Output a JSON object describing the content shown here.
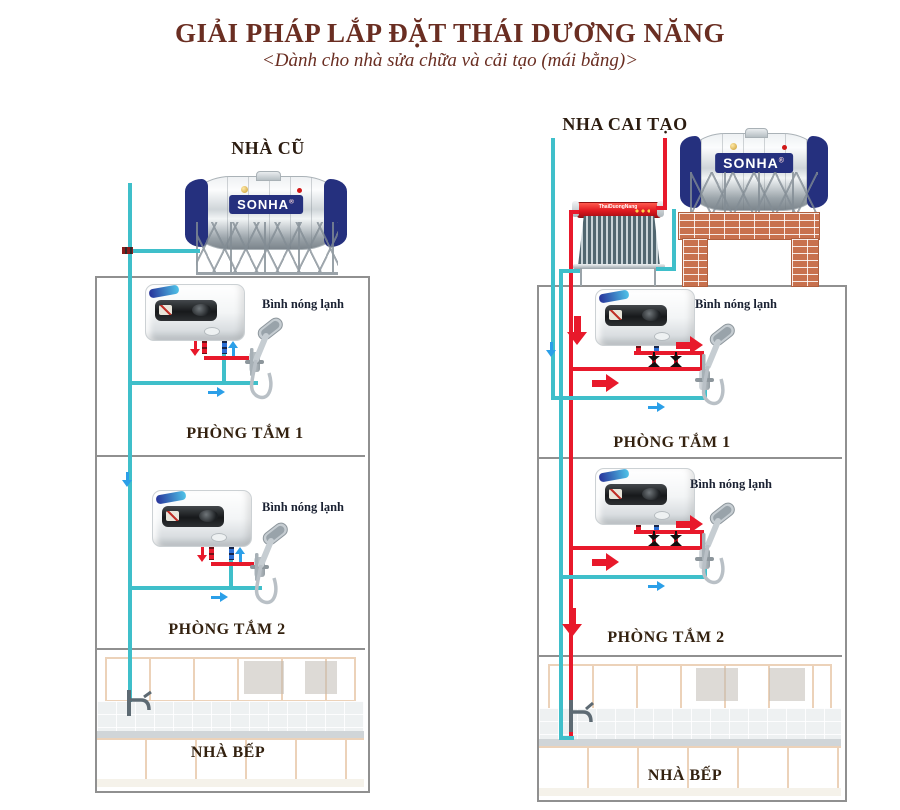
{
  "title": {
    "text": "GIẢI PHÁP LẮP ĐẶT THÁI DƯƠNG NĂNG",
    "subtitle": "<Dành cho nhà sửa chữa và cải tạo (mái bằng)>"
  },
  "colors": {
    "title_brown": "#6a2e22",
    "label_dark": "#33210f",
    "heater_label_dark": "#1b2233",
    "hot_pipe": "#e8192b",
    "cold_pipe": "#3fbfca",
    "arrow_blue": "#2b9fe8",
    "brick": "#c8714e",
    "tank_navy": "#25307e",
    "collector_red": "#e01820",
    "box_border": "#909090"
  },
  "left": {
    "header": "NHÀ CŨ",
    "tank_brand": "SONHA",
    "tank_brand_mark": "®",
    "heater_label": "Bình nóng lạnh",
    "rooms": {
      "bathroom1": "PHÒNG TẮM 1",
      "bathroom2": "PHÒNG TẮM 2",
      "kitchen": "NHÀ BẾP"
    }
  },
  "right": {
    "header": "NHA CAI TẠO",
    "tank_brand": "SONHA",
    "tank_brand_mark": "®",
    "collector_brand": "ThaiDuongNang",
    "heater_label": "Bình nóng lạnh",
    "rooms": {
      "bathroom1": "PHÒNG TẮM 1",
      "bathroom2": "PHÒNG TẮM 2",
      "kitchen": "NHÀ BẾP"
    }
  }
}
